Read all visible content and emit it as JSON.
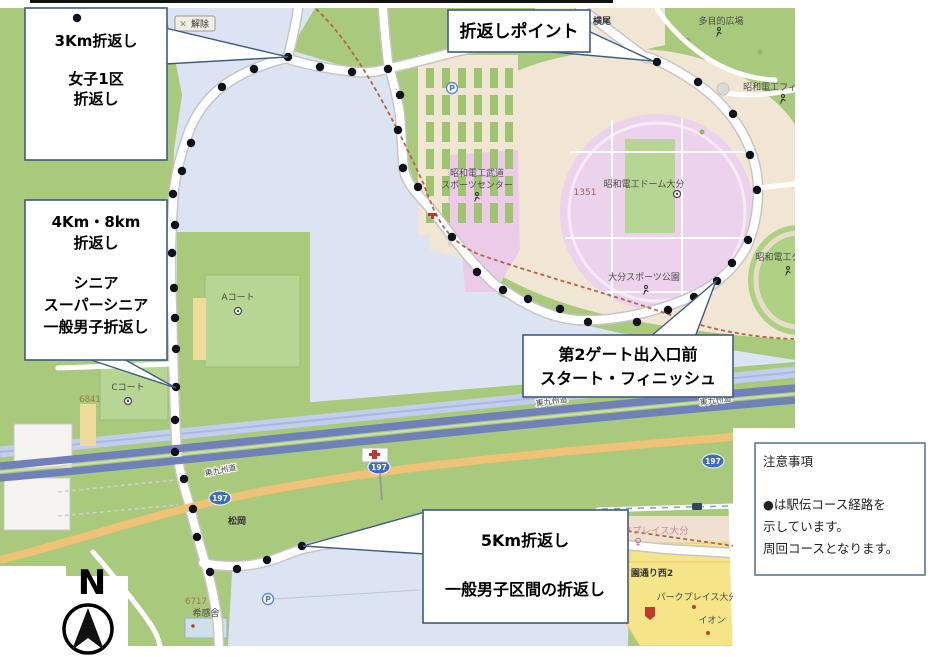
{
  "map": {
    "clear_button": "解除",
    "labels": {
      "yokoo": "横尾",
      "tamokuteki_hiroba": "多目的広場",
      "showa_denko_field": "昭和電工フィ",
      "budo_line1": "昭和電工武道",
      "budo_line2": "スポーツセンター",
      "dome": "昭和電工ドーム大分",
      "block_1351": "1351",
      "sports_park": "大分スポーツ公園",
      "showa_denko_ground": "昭和電工グ",
      "a_court": "Aコート",
      "c_court": "Cコート",
      "block_6841": "6841",
      "block_6717": "6717",
      "kikansha": "希感舎",
      "matsuoka": "松岡",
      "higashi_kyushu_expwy": "東九州道",
      "route_197": "197",
      "park_place_oita_pink": "パークプレイス大分",
      "koendori_nishi2": "園通り西2",
      "park_place_oita": "パークプレイス大分",
      "aeon": "イオン"
    }
  },
  "callouts": {
    "c1": {
      "line1": "3Km折返し",
      "line2": "女子1区",
      "line3": "折返し"
    },
    "c2": {
      "label": "折返しポイント"
    },
    "c3": {
      "line1": "4Km・8km",
      "line2": "折返し",
      "line3": "シニア",
      "line4": "スーパーシニア",
      "line5": "一般男子折返し"
    },
    "c4": {
      "line1": "第2ゲート出入口前",
      "line2": "スタート・フィニッシュ"
    },
    "c5": {
      "line1": "5Km折返し",
      "line2": "一般男子区間の折返し"
    },
    "notes": {
      "title": "注意事項",
      "line1": "●は駅伝コース経路を",
      "line2": "示しています。",
      "line3": "周回コースとなります。"
    }
  },
  "compass": {
    "label": "N"
  },
  "icons": {
    "close": "✕",
    "parking": "P",
    "female": "♀"
  },
  "colors": {
    "course_dot": "#10101c",
    "callout_border": "#3e5c7e",
    "map_green": "#a9c97c",
    "water_blue": "#dce3f2",
    "stadium_pink": "#ecd2ec",
    "highway_blue": "#7080b8",
    "route_orange": "#f0c277",
    "commercial_yellow": "#f6e489"
  }
}
